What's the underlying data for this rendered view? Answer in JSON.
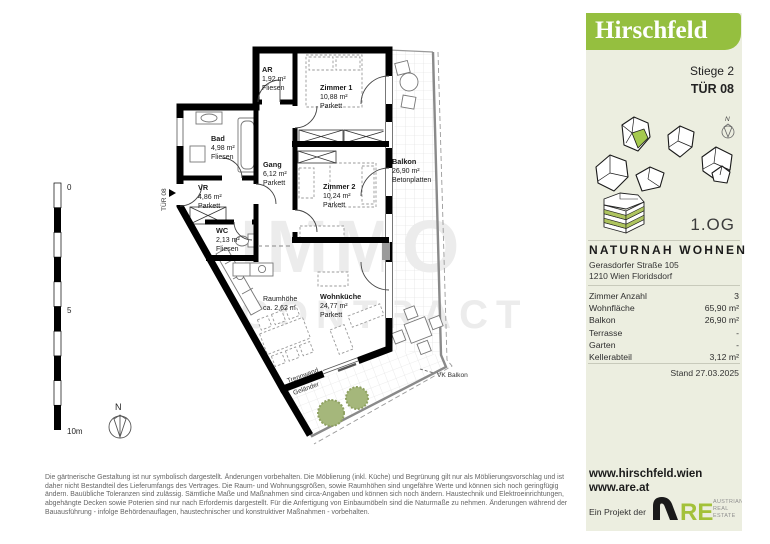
{
  "plan": {
    "rooms": {
      "ar": {
        "name": "AR",
        "area": "1,92 m²",
        "floor": "Fliesen"
      },
      "zimmer1": {
        "name": "Zimmer 1",
        "area": "10,88 m²",
        "floor": "Parkett"
      },
      "bad": {
        "name": "Bad",
        "area": "4,98 m²",
        "floor": "Fliesen"
      },
      "gang": {
        "name": "Gang",
        "area": "6,12 m²",
        "floor": "Parkett"
      },
      "zimmer2": {
        "name": "Zimmer 2",
        "area": "10,24 m²",
        "floor": "Parkett"
      },
      "vr": {
        "name": "VR",
        "area": "4,86 m²",
        "floor": "Parkett"
      },
      "wc": {
        "name": "WC",
        "area": "2,13 m²",
        "floor": "Fliesen"
      },
      "balkon": {
        "name": "Balkon",
        "area": "26,90 m²",
        "floor": "Betonplatten"
      },
      "wohnkueche": {
        "name": "Wohnküche",
        "area": "24,77 m²",
        "floor": "Parkett"
      }
    },
    "raumhoehe": {
      "label": "Raumhöhe",
      "value": "ca. 2,62 m"
    },
    "tuer_label": "TÜR 08",
    "vk_balkon": "VK Balkon",
    "trennwand": "Trennwand",
    "gelaender": "Geländer",
    "scale": {
      "zero": "0",
      "five": "5",
      "ten": "10m"
    },
    "north": "N",
    "watermark1": "IMMO",
    "watermark2": "CONTRACT"
  },
  "sidebar": {
    "logo": "Hirschfeld",
    "stiege": "Stiege 2",
    "tuer": "TÜR 08",
    "north": "N",
    "floor": "1.OG",
    "project_name": "NATURNAH WOHNEN",
    "address_line1": "Gerasdorfer Straße 105",
    "address_line2": "1210 Wien Floridsdorf",
    "facts": [
      {
        "label": "Zimmer Anzahl",
        "value": "3"
      },
      {
        "label": "Wohnfläche",
        "value": "65,90 m²"
      },
      {
        "label": "Balkon",
        "value": "26,90 m²"
      },
      {
        "label": "Terrasse",
        "value": "-"
      },
      {
        "label": "Garten",
        "value": "-"
      },
      {
        "label": "Kellerabteil",
        "value": "3,12 m²"
      }
    ],
    "stand": "Stand 27.03.2025",
    "website1": "www.hirschfeld.wien",
    "website2": "www.are.at",
    "project_by": "Ein Projekt der",
    "are": {
      "re": "RE",
      "line1": "AUSTRIAN",
      "line2": "REAL",
      "line3": "ESTATE"
    }
  },
  "footer": {
    "line1": "Die gärtnerische Gestaltung ist nur symbolisch dargestellt. Änderungen vorbehalten. Die Möblierung (inkl. Küche) und Begrünung gilt nur als Möblierungsvorschlag und ist",
    "line2": "daher nicht Bestandteil des Lieferumfangs des Vertrages. Die Raum- und Wohnungsgrößen, sowie Raumhöhen sind ungefähre Werte und können sich noch geringfügig",
    "line3": "ändern. Bauübliche Toleranzen sind zulässig. Sämtliche Maße und Maßnahmen sind circa-Angaben und können sich noch ändern. Haustechnik und Elektroeinrichtungen,",
    "line4": "abgehängte Decken sowie Poterien sind nur nach Erfordernis dargestellt. Für die Anfertigung von Einbaumöbeln sind die Naturmaße zu nehmen. Änderungen während der",
    "line5": "Bauausführung - infolge Behördenauflagen, haustechnischer und konstruktiver Maßnahmen - vorbehalten."
  },
  "colors": {
    "brand_green": "#95bf3f",
    "panel_bg": "#eceee0",
    "are_green": "#a3c139",
    "tree_green": "#a5b77b"
  }
}
